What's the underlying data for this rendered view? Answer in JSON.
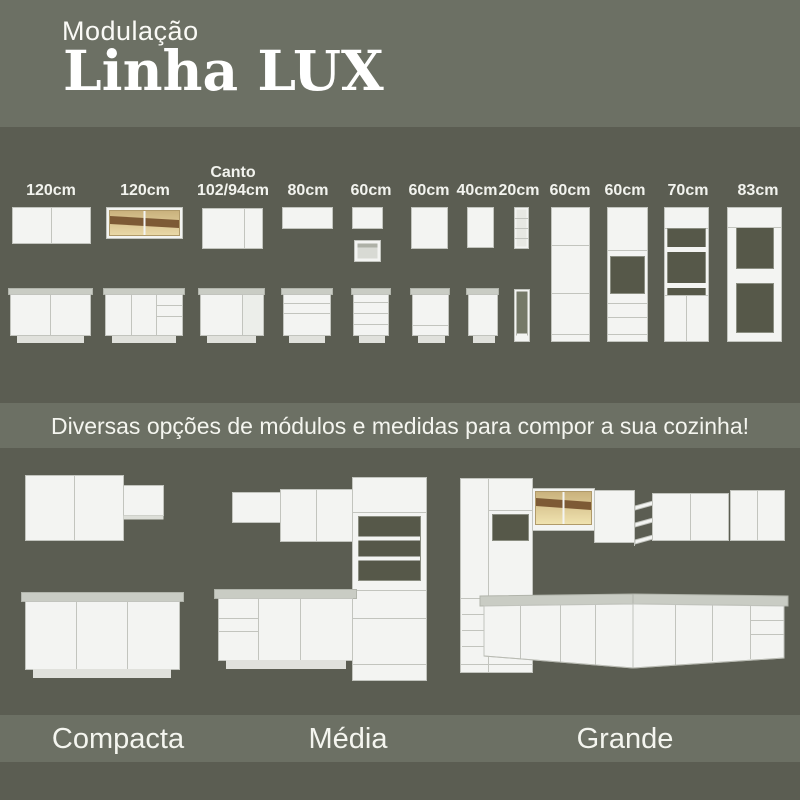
{
  "header": {
    "kicker": "Modulação",
    "title": "Linha LUX"
  },
  "modules": {
    "items": [
      {
        "id": "wall-120-two-door",
        "label_top": "",
        "size": "120cm"
      },
      {
        "id": "wall-120-glass",
        "label_top": "",
        "size": "120cm"
      },
      {
        "id": "wall-corner",
        "label_top": "Canto",
        "size": "102/94cm"
      },
      {
        "id": "wall-80",
        "label_top": "",
        "size": "80cm"
      },
      {
        "id": "wall-60-a",
        "label_top": "",
        "size": "60cm"
      },
      {
        "id": "wall-60-b",
        "label_top": "",
        "size": "60cm"
      },
      {
        "id": "wall-40",
        "label_top": "",
        "size": "40cm"
      },
      {
        "id": "niche-20",
        "label_top": "",
        "size": "20cm"
      },
      {
        "id": "tall-60-pantry",
        "label_top": "",
        "size": "60cm"
      },
      {
        "id": "tall-60-oven",
        "label_top": "",
        "size": "60cm"
      },
      {
        "id": "tall-70-microwave",
        "label_top": "",
        "size": "70cm"
      },
      {
        "id": "tall-83-fridge",
        "label_top": "",
        "size": "83cm"
      }
    ]
  },
  "banner": {
    "text": "Diversas opções de módulos e medidas para compor a sua cozinha!"
  },
  "kitchens": {
    "items": [
      {
        "name": "Compacta"
      },
      {
        "name": "Média"
      },
      {
        "name": "Grande"
      }
    ]
  },
  "colors": {
    "band_light": "#6C7064",
    "band_dark": "#5B5D52",
    "cabinet_white": "#F3F4F2",
    "countertop_gray": "#C9CCC4",
    "glass_amber": "#D9C28C",
    "glass_wood_brown": "#7D5A35"
  }
}
